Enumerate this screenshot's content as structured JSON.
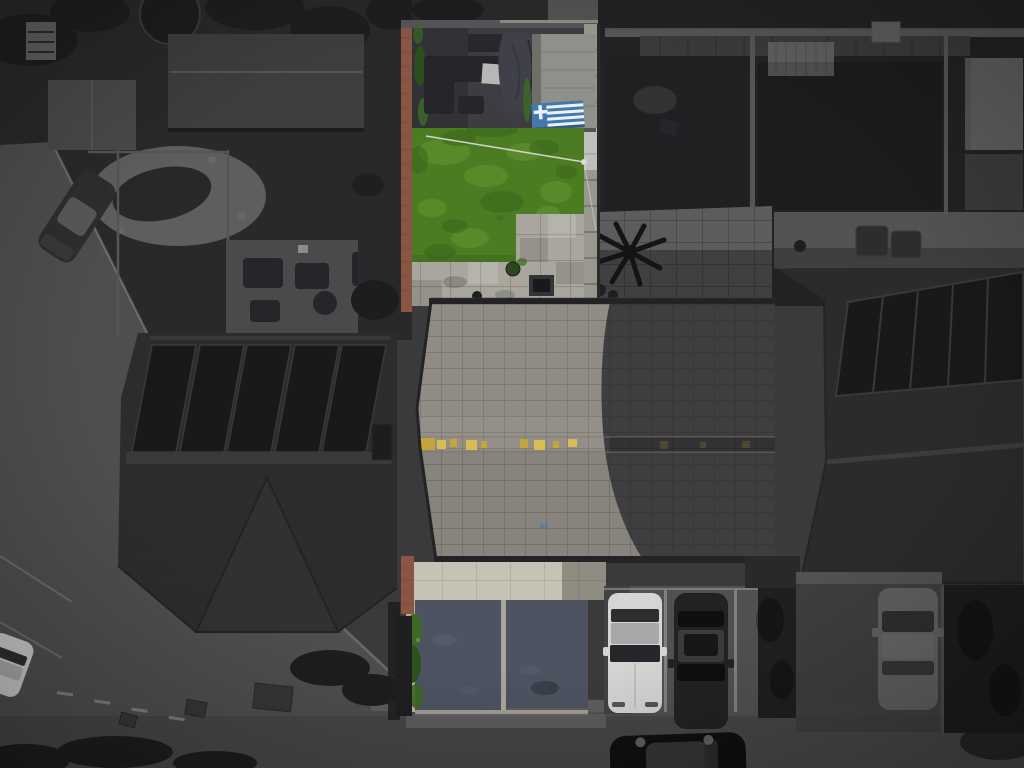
{
  "meta": {
    "type": "aerial-drone-photo",
    "style": "selective-color (subject property in color, surroundings grayscale)",
    "subject": "terraced house with rear garden, roof and driveway"
  },
  "palette": {
    "base": "#3a3a3c",
    "gardenDark": "#29292b",
    "gardenDarker": "#222224",
    "treeDark": "#1d1d1f",
    "road": "#4e4e50",
    "roadBottom": "#454547",
    "pavement": "#5e5e60",
    "curb": "#707072",
    "marking": "#a0a0a2",
    "manhole": "#363638",
    "roofLeft": "#2c2c2e",
    "roofLeftFront": "#313133",
    "ridgeLight": "#3a3a3c",
    "solar": "#19191b",
    "solarLine": "#39393b",
    "shedBig": "#3f3e3e",
    "shedSmall": "#4a4a4a",
    "gravel": "#5e5e5c",
    "pond": "#28282a",
    "patioGrey": "#5c5c5e",
    "patioShade": "#49494c",
    "fenceLight": "#98988f",
    "fenceMid": "#555557",
    "hedge": "#1f1f21",
    "hedgeRight": "#1c1c1e",
    "roofRight": "#2b2b2d",
    "ridgeRight": "#3c3c3e",
    "brick": "#8b5544",
    "brickDark": "#6d4234",
    "patioWet": "#3c3c43",
    "furnDark": "#25252a",
    "tableLight": "#b7b7b5",
    "tarp": "#40404a",
    "shedRoof": "#8f908a",
    "shedRoofDark": "#6e6f69",
    "flagBlue": "#4478ac",
    "flagWhite": "#eaf1f6",
    "lawn": "#4c7c22",
    "lawnLight": "#639430",
    "lawnDark": "#3a651b",
    "washLine": "#dadad8",
    "pavingLit": "#a9a79d",
    "pavingLine": "#8f8d84",
    "drain": "#33333a",
    "potGreen": "#2d471c",
    "roofLit": "#908c85",
    "roofLitLine": "#7d7971",
    "roofShad": "#3e3e41",
    "roofShadLine": "#38383b",
    "eave": "#232325",
    "lichen": "#c6a43c",
    "lichenLight": "#d9bc52",
    "driveBand": "#c6c2b4",
    "tarmac": "#4d5361",
    "tarmacLight": "#5c6270",
    "driveLine": "#b4b0a3",
    "shrub": "#3c6a24",
    "shrubDark": "#2c531a",
    "bay": "#515153",
    "bayLine": "#8d8d8f",
    "carWhite": "#d5d5d3",
    "carWhiteRoof": "#a8a8a6",
    "carDark": "#222224",
    "carDarkRoof": "#3b3b3d",
    "carGray": "#5f5f61",
    "carGrayRoof": "#666668",
    "carBlack": "#0f0f11",
    "carBlackRoof": "#343436",
    "glass": "#2e2e30",
    "whiteCarSmall": "#c8c8c6",
    "roadCar": "#2e2e30",
    "roadCarRoof": "#58585a",
    "binDark": "#2d2d2f",
    "palm": "#141416"
  },
  "scene": {
    "objects": [
      {
        "name": "subject-garden",
        "features": [
          "green-lawn",
          "washing-line",
          "dark-patio-with-furniture",
          "tarp-covered-item",
          "shed",
          "greek-flag-table",
          "light-paving",
          "red-brick-wall"
        ]
      },
      {
        "name": "subject-house-roof",
        "features": [
          "lit-grey-tiles",
          "ridge-with-yellow-lichen",
          "diagonal-shadow"
        ]
      },
      {
        "name": "subject-driveway",
        "features": [
          "bright-paving-band",
          "two-tarmac-panels",
          "green-shrubs",
          "brick-pillar"
        ]
      },
      {
        "name": "left-house",
        "features": [
          "dark-hipped-roof",
          "five-solar-panels",
          "front-hip"
        ]
      },
      {
        "name": "right-house",
        "features": [
          "dark-hipped-roof",
          "solar-array"
        ]
      },
      {
        "name": "top-left-gardens",
        "features": [
          "large-shed",
          "small-shed",
          "trampoline",
          "gravel-rockery-pond",
          "patio-furniture"
        ]
      },
      {
        "name": "top-right-gardens",
        "features": [
          "dark-lawns",
          "fences",
          "corrugated-pergola",
          "neighbor-patio",
          "palm-plant",
          "wheelie-bins"
        ]
      },
      {
        "name": "roads",
        "features": [
          "left-diagonal-road",
          "bottom-road",
          "kerb-lines",
          "manholes",
          "parking-dashes"
        ]
      },
      {
        "name": "cars",
        "features": [
          "angled-parked-car-road",
          "white-car-left-edge",
          "white-car-bay",
          "dark-car-bay",
          "gray-car-right-drive",
          "black-car-bottom-road"
        ]
      }
    ]
  }
}
